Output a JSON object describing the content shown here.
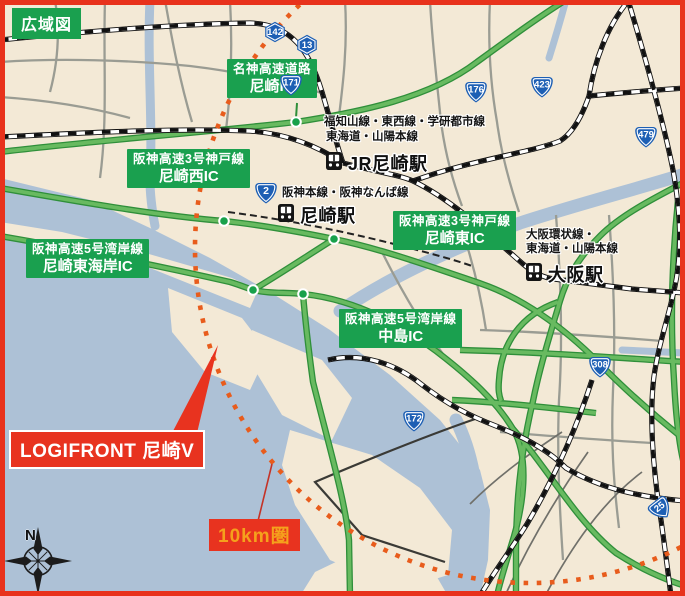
{
  "map_title": "広域図",
  "site": {
    "label": "LOGIFRONT 尼崎V"
  },
  "radius": {
    "label": "10km圏"
  },
  "compass": {
    "north": "N"
  },
  "ic_labels": [
    {
      "line1": "名神高速道路",
      "line2": "尼崎IC"
    },
    {
      "line1": "阪神高速3号神戸線",
      "line2": "尼崎西IC"
    },
    {
      "line1": "阪神高速3号神戸線",
      "line2": "尼崎東IC"
    },
    {
      "line1": "阪神高速5号湾岸線",
      "line2": "尼崎東海岸IC"
    },
    {
      "line1": "阪神高速5号湾岸線",
      "line2": "中島IC"
    }
  ],
  "stations": [
    {
      "name": "JR尼崎駅",
      "note1": "福知山線・東西線・学研都市線",
      "note2": "東海道・山陽本線"
    },
    {
      "name": "尼崎駅",
      "note1": "阪神本線・阪神なんば線"
    },
    {
      "name": "大阪駅",
      "note1": "大阪環状線・",
      "note2": "東海道・山陽本線"
    }
  ],
  "route_shields": [
    {
      "num": "171"
    },
    {
      "num": "142"
    },
    {
      "num": "13"
    },
    {
      "num": "176"
    },
    {
      "num": "423"
    },
    {
      "num": "479"
    },
    {
      "num": "2"
    },
    {
      "num": "308"
    },
    {
      "num": "172"
    },
    {
      "num": "25"
    }
  ],
  "colors": {
    "frame_red": "#e8321c",
    "label_green": "#1aa04f",
    "highway_green": "#68ba60",
    "water": "#adc1d6",
    "land": "#f3e9d6",
    "radius_circle_orange": "#e85c1c",
    "radius_text_orange": "#f5a11c",
    "site_red": "#e8331f",
    "shield_blue": "#1d5fb4"
  }
}
